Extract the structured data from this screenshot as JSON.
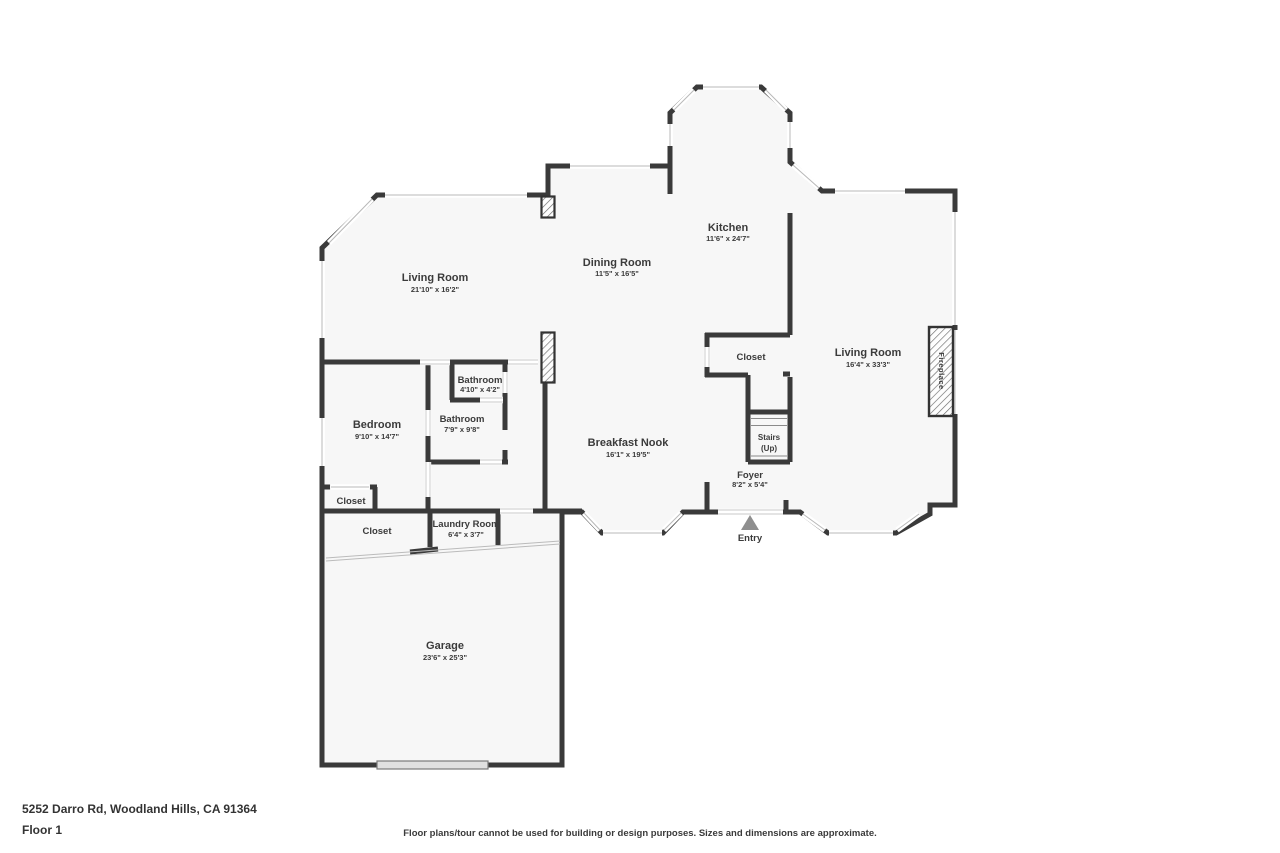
{
  "colors": {
    "wall": "#3a3a3a",
    "floor": "#f7f7f7",
    "window_glass": "#b8b8b8",
    "entry_marker": "#8f8f8f"
  },
  "rooms": {
    "living_room_left": {
      "label": "Living Room",
      "dims": "21'10\" x 16'2\""
    },
    "dining_room": {
      "label": "Dining Room",
      "dims": "11'5\" x 16'5\""
    },
    "kitchen": {
      "label": "Kitchen",
      "dims": "11'6\" x 24'7\""
    },
    "living_room_right": {
      "label": "Living Room",
      "dims": "16'4\" x 33'3\""
    },
    "breakfast_nook": {
      "label": "Breakfast Nook",
      "dims": "16'1\" x 19'5\""
    },
    "bedroom": {
      "label": "Bedroom",
      "dims": "9'10\" x 14'7\""
    },
    "bathroom_upper": {
      "label": "Bathroom",
      "dims": "4'10\" x 4'2\""
    },
    "bathroom_lower": {
      "label": "Bathroom",
      "dims": "7'9\" x 9'8\""
    },
    "closet_bedroom": {
      "label": "Closet"
    },
    "closet_hall": {
      "label": "Closet"
    },
    "closet_foyer": {
      "label": "Closet"
    },
    "laundry_room": {
      "label": "Laundry Room",
      "dims": "6'4\" x 3'7\""
    },
    "garage": {
      "label": "Garage",
      "dims": "23'6\" x 25'3\""
    },
    "stairs": {
      "label": "Stairs",
      "sub": "(Up)"
    },
    "foyer": {
      "label": "Foyer",
      "dims": "8'2\" x 5'4\""
    },
    "entry": {
      "label": "Entry"
    },
    "fireplace": {
      "label": "Fireplace"
    }
  },
  "footer": {
    "address": "5252 Darro Rd, Woodland Hills, CA 91364",
    "floor": "Floor 1",
    "disclaimer": "Floor plans/tour cannot be used for building or design purposes. Sizes and dimensions are approximate."
  }
}
